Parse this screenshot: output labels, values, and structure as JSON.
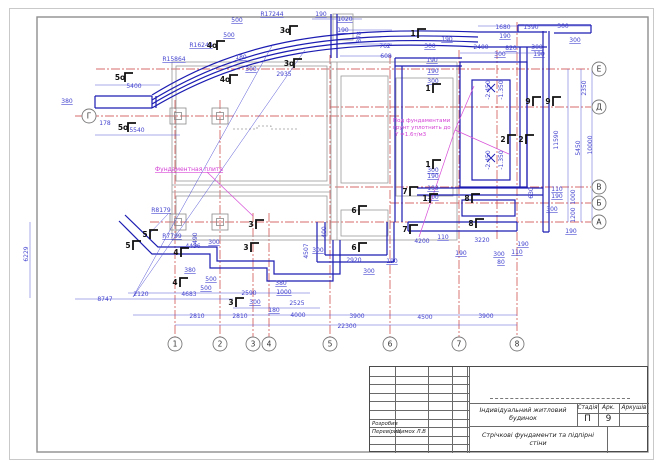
{
  "title_block": {
    "project": "Індивідуальний житловий будинок",
    "doc_title_line1": "Стрічкові фундаменти та підпірні",
    "doc_title_line2": "стіни",
    "stage_label": "Стадія",
    "stage_value": "П",
    "sheet_label": "Арк.",
    "sheet_value": "9",
    "sheets_label": "Аркушів",
    "sheets_value": "",
    "developed_label": "Розробив",
    "checked_label": "Перевірив",
    "checked_name": "Цимох Л.В"
  },
  "notes": {
    "slab": "Фундаментная плита",
    "soil_line1": "Под фундаментами",
    "soil_line2": "грунт уплотнить до",
    "soil_line3": "Y =1.6т/м3"
  },
  "axis_markers": {
    "bottom": [
      {
        "label": "1",
        "x": 175,
        "y": 344
      },
      {
        "label": "2",
        "x": 220,
        "y": 344
      },
      {
        "label": "3",
        "x": 253,
        "y": 344
      },
      {
        "label": "4",
        "x": 269,
        "y": 344
      },
      {
        "label": "5",
        "x": 330,
        "y": 344
      },
      {
        "label": "6",
        "x": 390,
        "y": 344
      },
      {
        "label": "7",
        "x": 459,
        "y": 344
      },
      {
        "label": "8",
        "x": 517,
        "y": 344
      }
    ],
    "right": [
      {
        "label": "Е",
        "x": 599,
        "y": 69
      },
      {
        "label": "Д",
        "x": 599,
        "y": 107
      },
      {
        "label": "В",
        "x": 599,
        "y": 187
      },
      {
        "label": "Б",
        "x": 599,
        "y": 203
      },
      {
        "label": "А",
        "x": 599,
        "y": 222
      }
    ],
    "left": [
      {
        "label": "Г",
        "x": 89,
        "y": 116
      }
    ]
  },
  "section_marks": [
    {
      "t": "5о",
      "x": 120,
      "y": 80
    },
    {
      "t": "5о",
      "x": 123,
      "y": 130
    },
    {
      "t": "4о",
      "x": 212,
      "y": 48
    },
    {
      "t": "4о",
      "x": 225,
      "y": 82
    },
    {
      "t": "3о",
      "x": 285,
      "y": 33
    },
    {
      "t": "3о",
      "x": 289,
      "y": 66
    },
    {
      "t": "1",
      "x": 413,
      "y": 36
    },
    {
      "t": "1",
      "x": 428,
      "y": 91
    },
    {
      "t": "1",
      "x": 428,
      "y": 167
    },
    {
      "t": "1",
      "x": 425,
      "y": 201
    },
    {
      "t": "9",
      "x": 528,
      "y": 104
    },
    {
      "t": "9",
      "x": 548,
      "y": 104
    },
    {
      "t": "2",
      "x": 503,
      "y": 142
    },
    {
      "t": "2",
      "x": 521,
      "y": 142
    },
    {
      "t": "7",
      "x": 405,
      "y": 194
    },
    {
      "t": "7",
      "x": 405,
      "y": 232
    },
    {
      "t": "6",
      "x": 354,
      "y": 213
    },
    {
      "t": "6",
      "x": 354,
      "y": 250
    },
    {
      "t": "8",
      "x": 467,
      "y": 201
    },
    {
      "t": "8",
      "x": 471,
      "y": 226
    },
    {
      "t": "3",
      "x": 251,
      "y": 227
    },
    {
      "t": "3",
      "x": 246,
      "y": 250
    },
    {
      "t": "3",
      "x": 231,
      "y": 305
    },
    {
      "t": "4",
      "x": 176,
      "y": 255
    },
    {
      "t": "4",
      "x": 175,
      "y": 285
    },
    {
      "t": "5",
      "x": 145,
      "y": 237
    },
    {
      "t": "5",
      "x": 128,
      "y": 248
    }
  ],
  "dimensions": [
    {
      "t": "R17244",
      "x": 272,
      "y": 16,
      "u": 1
    },
    {
      "t": "500",
      "x": 237,
      "y": 22,
      "u": 1
    },
    {
      "t": "500",
      "x": 229,
      "y": 37,
      "u": 1
    },
    {
      "t": "R16244",
      "x": 201,
      "y": 47,
      "u": 1
    },
    {
      "t": "R15864",
      "x": 174,
      "y": 61,
      "u": 1
    },
    {
      "t": "190",
      "x": 321,
      "y": 16,
      "u": 1
    },
    {
      "t": "1020",
      "x": 345,
      "y": 21,
      "u": 1
    },
    {
      "t": "190",
      "x": 343,
      "y": 32,
      "u": 1
    },
    {
      "t": "878",
      "x": 361,
      "y": 37,
      "r": 1
    },
    {
      "t": "762",
      "x": 385,
      "y": 48
    },
    {
      "t": "608",
      "x": 386,
      "y": 58
    },
    {
      "t": "180",
      "x": 241,
      "y": 59,
      "u": 1
    },
    {
      "t": "300",
      "x": 251,
      "y": 71,
      "u": 1
    },
    {
      "t": "2935",
      "x": 284,
      "y": 76
    },
    {
      "t": "5400",
      "x": 134,
      "y": 88
    },
    {
      "t": "380",
      "x": 67,
      "y": 103,
      "u": 1
    },
    {
      "t": "178",
      "x": 105,
      "y": 125
    },
    {
      "t": "5540",
      "x": 137,
      "y": 132
    },
    {
      "t": "190",
      "x": 447,
      "y": 41,
      "u": 1
    },
    {
      "t": "1680",
      "x": 503,
      "y": 29
    },
    {
      "t": "190",
      "x": 505,
      "y": 38,
      "u": 1
    },
    {
      "t": "1590",
      "x": 531,
      "y": 29
    },
    {
      "t": "300",
      "x": 563,
      "y": 28
    },
    {
      "t": "2400",
      "x": 481,
      "y": 49
    },
    {
      "t": "820",
      "x": 511,
      "y": 50,
      "u": 1
    },
    {
      "t": "300",
      "x": 537,
      "y": 49,
      "u": 1
    },
    {
      "t": "300",
      "x": 500,
      "y": 56,
      "u": 1
    },
    {
      "t": "190",
      "x": 539,
      "y": 56,
      "u": 1
    },
    {
      "t": "300",
      "x": 575,
      "y": 42,
      "u": 1
    },
    {
      "t": "300",
      "x": 430,
      "y": 48,
      "u": 1
    },
    {
      "t": "190",
      "x": 432,
      "y": 62,
      "u": 1
    },
    {
      "t": "190",
      "x": 433,
      "y": 73,
      "u": 1
    },
    {
      "t": "300",
      "x": 433,
      "y": 83,
      "u": 1
    },
    {
      "t": "300",
      "x": 433,
      "y": 172,
      "u": 1
    },
    {
      "t": "190",
      "x": 433,
      "y": 178,
      "u": 1
    },
    {
      "t": "190",
      "x": 433,
      "y": 190,
      "u": 1
    },
    {
      "t": "300",
      "x": 433,
      "y": 199,
      "u": 1
    },
    {
      "t": "-2.450",
      "x": 490,
      "y": 90,
      "r": 1
    },
    {
      "t": "-1.350",
      "x": 503,
      "y": 90,
      "r": 1
    },
    {
      "t": "-2.450",
      "x": 490,
      "y": 160,
      "r": 1
    },
    {
      "t": "-1.350",
      "x": 503,
      "y": 160,
      "r": 1
    },
    {
      "t": "2350",
      "x": 586,
      "y": 88,
      "r": 1
    },
    {
      "t": "11590",
      "x": 558,
      "y": 140,
      "r": 1
    },
    {
      "t": "5450",
      "x": 580,
      "y": 148,
      "r": 1
    },
    {
      "t": "10000",
      "x": 592,
      "y": 145,
      "r": 1
    },
    {
      "t": "630",
      "x": 533,
      "y": 193,
      "r": 1
    },
    {
      "t": "110",
      "x": 557,
      "y": 191,
      "u": 1
    },
    {
      "t": "190",
      "x": 557,
      "y": 198,
      "u": 1
    },
    {
      "t": "1000",
      "x": 575,
      "y": 197,
      "r": 1
    },
    {
      "t": "300",
      "x": 552,
      "y": 211,
      "u": 1
    },
    {
      "t": "1200",
      "x": 575,
      "y": 215,
      "r": 1
    },
    {
      "t": "190",
      "x": 571,
      "y": 233,
      "u": 1
    },
    {
      "t": "400",
      "x": 326,
      "y": 232,
      "r": 1
    },
    {
      "t": "300",
      "x": 318,
      "y": 252,
      "u": 1
    },
    {
      "t": "2920",
      "x": 354,
      "y": 262
    },
    {
      "t": "190",
      "x": 392,
      "y": 263,
      "u": 1
    },
    {
      "t": "300",
      "x": 369,
      "y": 273,
      "u": 1
    },
    {
      "t": "4200",
      "x": 422,
      "y": 243
    },
    {
      "t": "110",
      "x": 443,
      "y": 239,
      "u": 1
    },
    {
      "t": "3220",
      "x": 482,
      "y": 242
    },
    {
      "t": "190",
      "x": 461,
      "y": 255,
      "u": 1
    },
    {
      "t": "300",
      "x": 499,
      "y": 256,
      "u": 1
    },
    {
      "t": "110",
      "x": 517,
      "y": 254,
      "u": 1
    },
    {
      "t": "80",
      "x": 501,
      "y": 264,
      "u": 1
    },
    {
      "t": "190",
      "x": 523,
      "y": 246,
      "u": 1
    },
    {
      "t": "4507",
      "x": 308,
      "y": 251,
      "r": 1
    },
    {
      "t": "R8179",
      "x": 161,
      "y": 212,
      "u": 1
    },
    {
      "t": "R7799",
      "x": 172,
      "y": 238,
      "u": 1
    },
    {
      "t": "6229",
      "x": 28,
      "y": 254,
      "r": 1
    },
    {
      "t": "2490",
      "x": 197,
      "y": 240,
      "r": 1
    },
    {
      "t": "4436",
      "x": 193,
      "y": 248
    },
    {
      "t": "300",
      "x": 214,
      "y": 244,
      "u": 1
    },
    {
      "t": "380",
      "x": 190,
      "y": 272,
      "u": 1
    },
    {
      "t": "500",
      "x": 211,
      "y": 281,
      "u": 1
    },
    {
      "t": "500",
      "x": 206,
      "y": 290,
      "u": 1
    },
    {
      "t": "2590",
      "x": 249,
      "y": 295
    },
    {
      "t": "380",
      "x": 281,
      "y": 285,
      "u": 1
    },
    {
      "t": "1000",
      "x": 284,
      "y": 294,
      "u": 1
    },
    {
      "t": "2525",
      "x": 297,
      "y": 305
    },
    {
      "t": "300",
      "x": 255,
      "y": 304,
      "u": 1
    },
    {
      "t": "180",
      "x": 274,
      "y": 312,
      "u": 1
    },
    {
      "t": "2120",
      "x": 141,
      "y": 296
    },
    {
      "t": "4683",
      "x": 189,
      "y": 296
    },
    {
      "t": "8747",
      "x": 105,
      "y": 301
    },
    {
      "t": "2810",
      "x": 197,
      "y": 318
    },
    {
      "t": "2810",
      "x": 240,
      "y": 318
    },
    {
      "t": "4000",
      "x": 298,
      "y": 317
    },
    {
      "t": "3900",
      "x": 357,
      "y": 318
    },
    {
      "t": "4500",
      "x": 425,
      "y": 319
    },
    {
      "t": "3900",
      "x": 486,
      "y": 318
    },
    {
      "t": "22300",
      "x": 347,
      "y": 328
    }
  ]
}
